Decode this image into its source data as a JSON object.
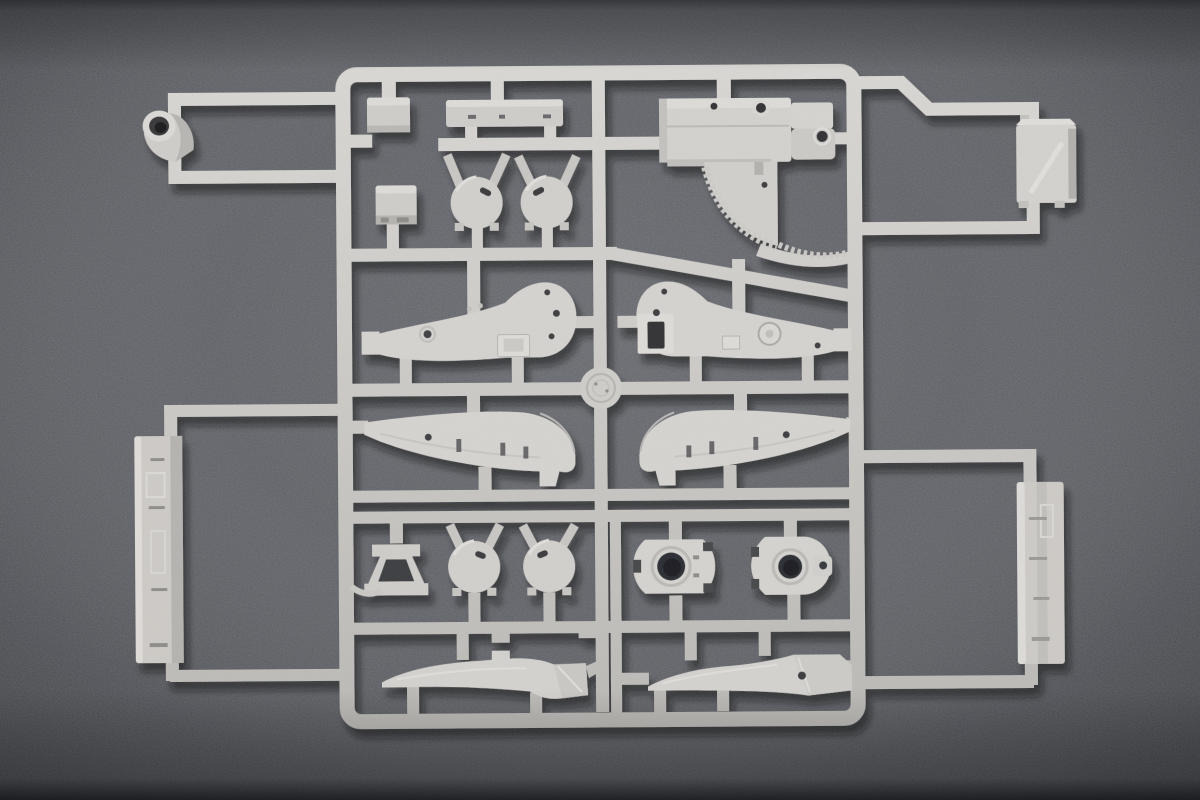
{
  "scene": {
    "type": "photograph",
    "subject": "Injection-molded plastic model kit sprue (runner) with artillery/tank parts",
    "setting": "Light gray styrene sprue lying on a dark gray flocked fabric surface, soft overhead light, vignetted edges"
  },
  "colors": {
    "background": "#595b60",
    "background_dark_edge": "#26282c",
    "plastic": "#cdcbc7",
    "plastic_highlight": "#dedcd8",
    "plastic_shade": "#b2b0ac",
    "cast_shadow": "#111317",
    "bore_dark": "#2b2d31"
  },
  "sprue": {
    "frame": "rectangular runner grid with cross runners, two attachment loops on the left and two on the right",
    "hub": "circular molding hub at the center crossing"
  },
  "parts": [
    {
      "id": "gun-barrel-muzzle",
      "label": "Hollow gun-barrel muzzle section (top left)"
    },
    {
      "id": "small-box-a",
      "label": "Small rectangular box"
    },
    {
      "id": "flat-bar",
      "label": "Long flat mounting bar"
    },
    {
      "id": "small-box-b",
      "label": "Small square box"
    },
    {
      "id": "dome-wheel-1",
      "label": "Domed hub cap (upper left pair)"
    },
    {
      "id": "dome-wheel-2",
      "label": "Domed hub cap (upper right pair)"
    },
    {
      "id": "breech-receiver",
      "label": "Gun breech block with toothed elevation quadrant"
    },
    {
      "id": "stowage-box",
      "label": "Stowage box with diagonal strap (far right)"
    },
    {
      "id": "side-plate-left",
      "label": "Carriage side plate, left half"
    },
    {
      "id": "side-plate-right",
      "label": "Carriage side plate, right half"
    },
    {
      "id": "shield-panel-left",
      "label": "Curved shield/fender panel, left"
    },
    {
      "id": "shield-panel-right",
      "label": "Curved shield/fender panel, right"
    },
    {
      "id": "a-frame-bracket",
      "label": "A-frame support bracket"
    },
    {
      "id": "wire-clip",
      "label": "Thin wire clip"
    },
    {
      "id": "dome-wheel-3",
      "label": "Domed hub cap (lower left pair)"
    },
    {
      "id": "dome-wheel-4",
      "label": "Domed hub cap (lower right pair)"
    },
    {
      "id": "mount-plate",
      "label": "Mount plate with large central bore"
    },
    {
      "id": "trunnion-ring",
      "label": "Trunnion ring with side lug"
    },
    {
      "id": "travel-lock-arm-left",
      "label": "Curved travel-lock arm, left"
    },
    {
      "id": "travel-lock-arm-right",
      "label": "Curved travel-lock arm, right"
    },
    {
      "id": "trail-beam-left",
      "label": "Long trail beam (left edge)"
    },
    {
      "id": "trail-beam-right",
      "label": "Long trail beam (right edge)"
    },
    {
      "id": "molding-hub",
      "label": "Central circular sprue hub"
    }
  ]
}
